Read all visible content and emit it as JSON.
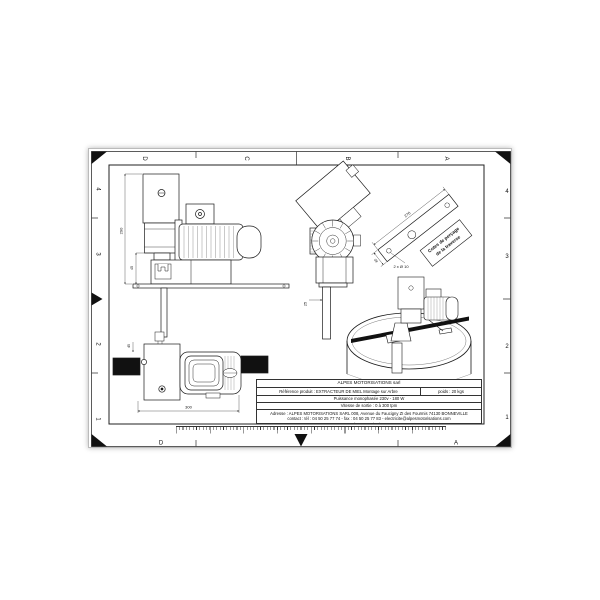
{
  "sheet": {
    "colors": {
      "ink": "#1a1a1a",
      "paper": "#ffffff",
      "solid_fill": "#111111"
    },
    "zones": {
      "top_letters": [
        "D",
        "C",
        "B",
        "A"
      ],
      "bottom_letters": [
        "D",
        "A"
      ],
      "left_numbers": [
        "4",
        "3",
        "2",
        "1"
      ],
      "right_numbers": [
        "4",
        "3",
        "2",
        "1"
      ]
    },
    "dimensions": {
      "front_height": "290",
      "front_offset": "45",
      "side_shaft": "25",
      "plan_width": "300",
      "plan_offset": "45",
      "traverse_length": "270",
      "traverse_width": "40",
      "traverse_holes": "2 x Ø 10"
    },
    "callout": {
      "line1": "Cotes de perçage",
      "line2": "de la traverse"
    },
    "title_block": {
      "company": "ALPES MOTORISATIONS sarl",
      "reference": "Référence produit : EXTRACTEUR DE MIEL Montage sur Arbre",
      "poids": "poids : 20 kgs",
      "puissance": "Puissance monophasée 230v - 180 W",
      "vitesse": "Vitesse de sortie : 0 à 300 tpm",
      "adresse": "Adresse : ALPES MOTORISATIONS SARL 008, Avenue du Faucigny ZI des Fourmis 74130 BONNEVILLE",
      "contact": "contact : tél : 04 50 25 77 74 - fax : 04 50 25 77 83 - electricite@alpesmotorisations.com",
      "website": "www.alpesmotorisations.com"
    }
  }
}
